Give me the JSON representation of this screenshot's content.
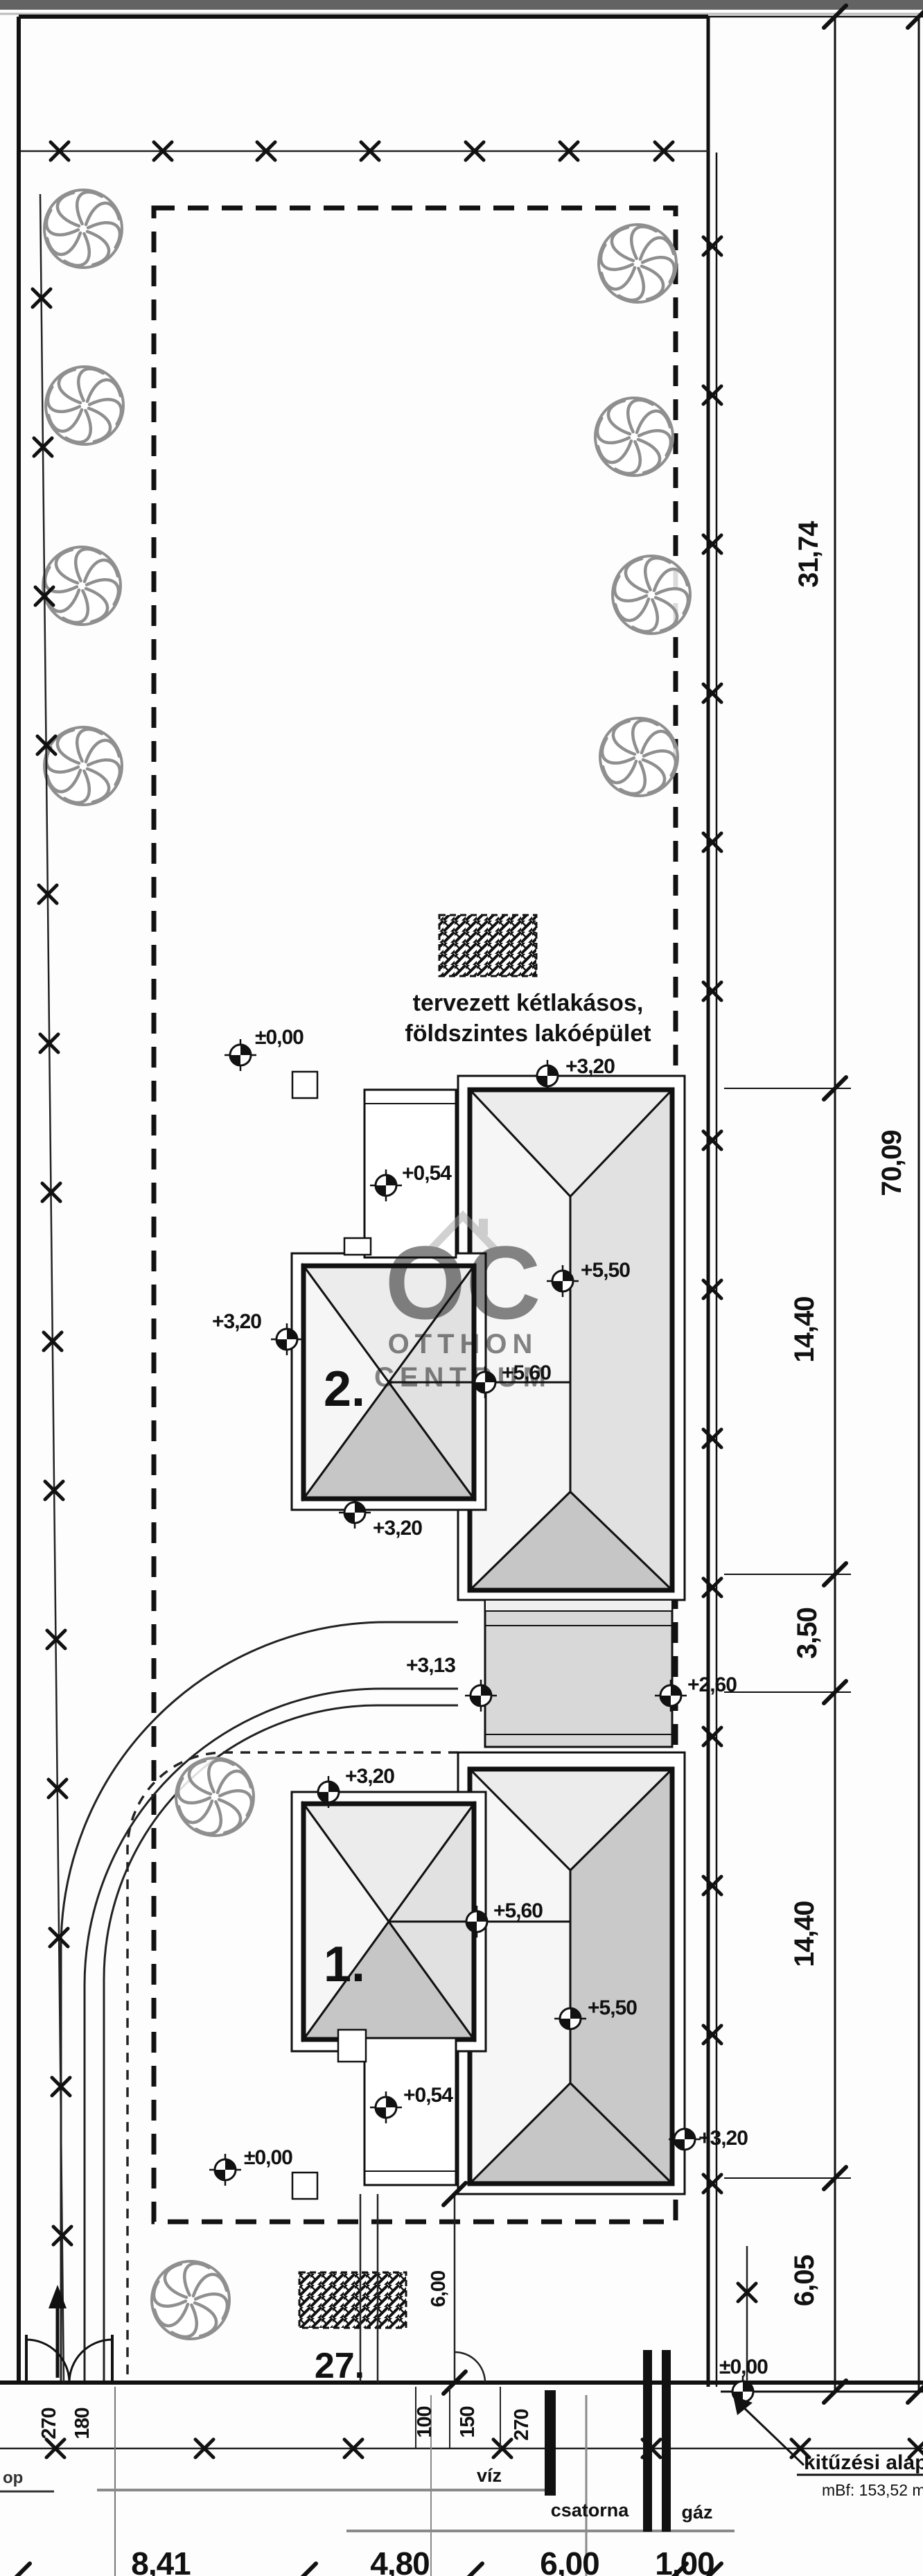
{
  "title_block": {
    "annotation_line1": "tervezett kétlakásos,",
    "annotation_line2": "földszintes lakóépület",
    "building_upper_label": "2.",
    "building_lower_label": "1.",
    "plot_number": "27.",
    "note_primary": "kitűzési alap",
    "note_secondary": "mBf: 153,52 m",
    "edge_fragment": "op"
  },
  "watermark": {
    "initials": "OC",
    "line1": "OTTHON",
    "line2": "CENTRUM"
  },
  "elevations": [
    {
      "label": "±0,00",
      "context": "upper-garden-ground"
    },
    {
      "label": "+3,20",
      "context": "house2-north-eave"
    },
    {
      "label": "+0,54",
      "context": "house2-terrace"
    },
    {
      "label": "+3,20",
      "context": "house2-west-eave"
    },
    {
      "label": "+5,50",
      "context": "house2-main-ridge"
    },
    {
      "label": "+5,60",
      "context": "house2-wing-ridge"
    },
    {
      "label": "+3,20",
      "context": "house2-south-eave"
    },
    {
      "label": "+3,13",
      "context": "connector-west"
    },
    {
      "label": "+2,60",
      "context": "connector-east"
    },
    {
      "label": "+3,20",
      "context": "house1-north-eave"
    },
    {
      "label": "+5,60",
      "context": "house1-wing-ridge"
    },
    {
      "label": "+5,50",
      "context": "house1-main-ridge"
    },
    {
      "label": "+0,54",
      "context": "house1-terrace"
    },
    {
      "label": "±0,00",
      "context": "lower-garden-ground"
    },
    {
      "label": "+3,20",
      "context": "house1-east-eave"
    },
    {
      "label": "±0,00",
      "context": "street-corner-benchmark"
    }
  ],
  "dimensions": {
    "right_segments": [
      "31,74",
      "14,40",
      "3,50",
      "14,40",
      "6,05"
    ],
    "right_total": "70,09",
    "bottom": [
      "8,41",
      "4,80",
      "6,00",
      "1,00"
    ],
    "front_small_left": [
      "270",
      "180"
    ],
    "front_small_mid": [
      "100",
      "150",
      "270"
    ],
    "front_setback": "6,00"
  },
  "utilities": {
    "water": "víz",
    "sewer": "csatorna",
    "gas": "gáz"
  },
  "colors": {
    "roof_light": "#f6f6f6",
    "roof_mid": "#ececec",
    "roof_east": "#e1e1e1",
    "roof_dark": "#c6c6c6",
    "roof_dark2": "#c9c9c9",
    "connector": "#d8d8d8",
    "connector_light": "#efefef",
    "watermark": "#a5a5a5",
    "line": "#111111",
    "utility_gray": "#8a8a8a",
    "road_band": "#636363"
  }
}
